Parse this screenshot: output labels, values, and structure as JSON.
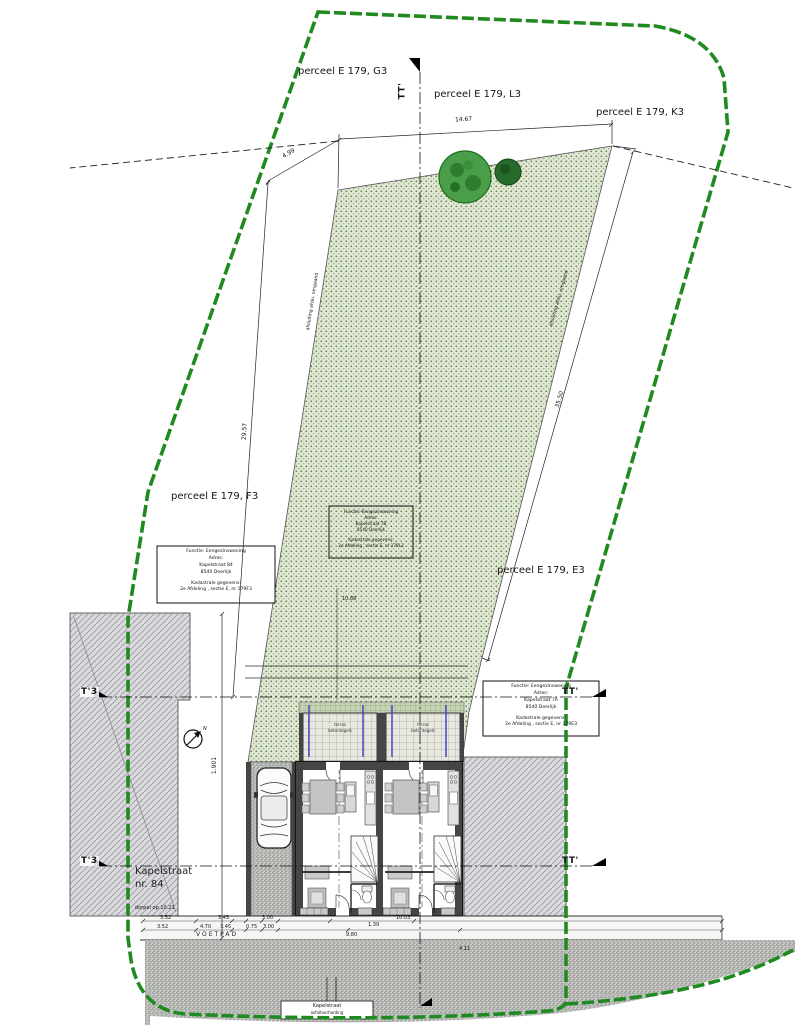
{
  "parcels": {
    "g3": "perceel E 179, G3",
    "l3": "perceel E 179, L3",
    "k3": "perceel E 179, K3",
    "f3": "perceel E 179, F3",
    "e3": "perceel E 179, E3"
  },
  "section_marks": {
    "top": "TT'",
    "right_upper": "TT'",
    "right_lower": "TT'",
    "left_upper": "T'3",
    "left_lower": "T'3"
  },
  "dims": {
    "top_width": "14.67",
    "top_left": "4.99",
    "left_depth": "29.57",
    "right_depth": "35.50",
    "left_height": "1.901",
    "garden_inner": "10.88",
    "row1": [
      "3.52",
      "3.45",
      "3.00",
      "1.39",
      "10.03"
    ],
    "row2": [
      "3.52",
      "4.70",
      "3.45",
      "0.75",
      "3.00",
      "9.80",
      "4.11"
    ]
  },
  "info_box_left": {
    "l1": "Functie: Eengezinswoning",
    "l2": "Adres:",
    "l3": "Kapelstraat 84",
    "l4": "8540 Deerlijk",
    "l5": "Kadastrale gegevens:",
    "l6": "2e Afdeling , sectie E, nr 179F3"
  },
  "info_box_middle": {
    "l1": "Functie: Eengezinswoning",
    "l2": "Adres:",
    "l3": "Kapelstraat 7B",
    "l4": "8540 Deerlijk",
    "l5": "Kadastrale gegevens:",
    "l6": "2e Afdeling , sectie E, nr 179L3"
  },
  "info_box_right": {
    "l1": "Functie: Eengezinswoning",
    "l2": "Adres:",
    "l3": "Kapelstraat 7A",
    "l4": "8540 Deerlijk",
    "l5": "Kadastrale gegevens:",
    "l6": "2e Afdeling , sectie E, nr 179E3"
  },
  "annotations": {
    "fence_left": "afsluiting afslu. omgaand",
    "fence_right": "afsluiting afslu. omgaand",
    "existing_house_line1": "Kapelstraat",
    "existing_house_line2": "nr. 84",
    "sill_note": "dorpel op 10.21",
    "sidewalk": "VOETPAD",
    "road_line1": "Kapelstraat",
    "road_line2": "asfaltverharding",
    "terrace_line1": "terras",
    "terrace_line2": "betontegels",
    "north": "N"
  },
  "colors": {
    "boundary_green": "#1f8a1f",
    "garden_fill": "#dfe7d2",
    "garden_dot": "#5d7c4c",
    "building_gray": "#dadade",
    "hatch_gray": "#9a9aa2",
    "wall_dark": "#454545",
    "blue_mark": "#3b3bd0",
    "line_black": "#1c1c1c"
  }
}
